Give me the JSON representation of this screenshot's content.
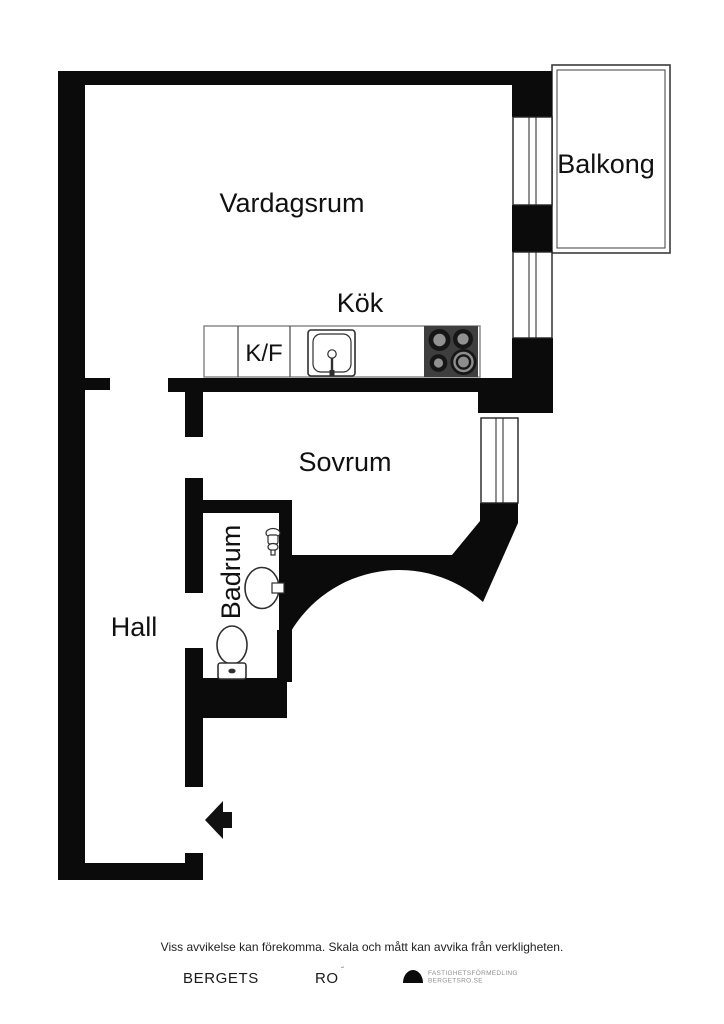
{
  "colors": {
    "wall": "#0b0b0b",
    "stove_body": "#3e3e3e",
    "burner_ring": "#161616",
    "burner_center": "#919191",
    "arrow": "#111111",
    "logo": "#0b0b0b"
  },
  "rooms": {
    "vardagsrum": "Vardagsrum",
    "kok": "Kök",
    "balkong": "Balkong",
    "sovrum": "Sovrum",
    "badrum": "Badrum",
    "hall": "Hall"
  },
  "kitchen": {
    "fridge_freezer": "K/F"
  },
  "icons": {
    "stove-icon": "4-burner cooktop",
    "sink-icon": "kitchen sink with faucet",
    "washbasin-icon": "bathroom washbasin",
    "toilet-icon": "toilet",
    "tap-icon": "wall-mounted tap",
    "entrance-arrow-icon": "entry direction arrow",
    "brokerage-logo-icon": "black dome logo"
  },
  "footer": {
    "disclaimer": "Viss avvikelse kan förekomma. Skala och mått kan avvika från verkligheten.",
    "brand_word1": "BERGETS",
    "brand_word2": "RO",
    "brand_mark": "˝",
    "logo_text_line1": "FASTIGHETSFÖRMEDLING",
    "logo_text_line2": "BERGETSRO.SE"
  }
}
